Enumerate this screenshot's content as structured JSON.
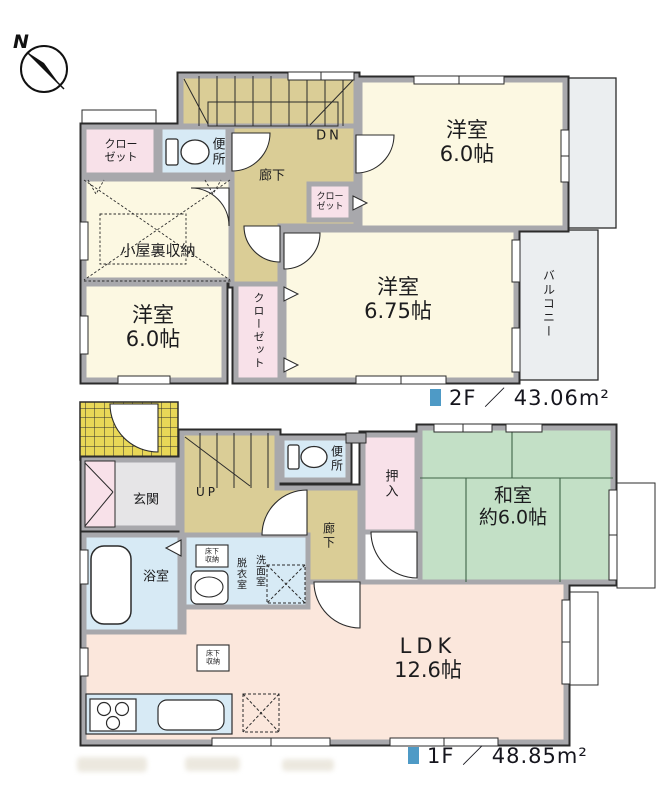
{
  "compass": {
    "north": "N"
  },
  "floor2": {
    "area_label": "2F ／ 43.06m²",
    "stairs_label": "DN",
    "rooms": {
      "yoshitsu_tr": {
        "name": "洋室",
        "size": "6.0帖"
      },
      "yoshitsu_675": {
        "name": "洋室",
        "size": "6.75帖"
      },
      "yoshitsu_bl": {
        "name": "洋室",
        "size": "6.0帖"
      },
      "attic": {
        "name": "小屋裏収納"
      },
      "closet_tl": {
        "line1": "クロー",
        "line2": "ゼット"
      },
      "closet_mid": {
        "line1": "クロー",
        "line2": "ゼット"
      },
      "closet_side": {
        "name": "クローゼット"
      },
      "toilet": {
        "name": "便所"
      },
      "hall": {
        "name": "廊下"
      },
      "balcony": {
        "name": "バルコニー"
      }
    }
  },
  "floor1": {
    "area_label": "1F ／ 48.85m²",
    "stairs_label": "UP",
    "rooms": {
      "genkan": {
        "name": "玄関"
      },
      "toilet": {
        "name": "便所"
      },
      "oshiire": {
        "name": "押入"
      },
      "washitsu": {
        "name": "和室",
        "size": "約6.0帖"
      },
      "hall": {
        "name": "廊下"
      },
      "bath": {
        "name": "浴室"
      },
      "datsui": {
        "name": "脱衣室"
      },
      "senmen": {
        "name": "洗面室"
      },
      "underfloor": {
        "line1": "床下",
        "line2": "収納"
      },
      "ldk": {
        "name": "LDK",
        "size": "12.6帖"
      }
    }
  },
  "colors": {
    "accent_blue": "#4E9AC6",
    "room_cream": "#FCF8E2",
    "hall_tan": "#DACD96",
    "closet_pink": "#F8E1E9",
    "wet_area_blue": "#D7EAF5",
    "tatami_green": "#C3E0C6",
    "ldk_peach": "#FBE7DC",
    "entrance_tile_yellow": "#E8D757",
    "wall_gray": "#A8A8AC"
  }
}
